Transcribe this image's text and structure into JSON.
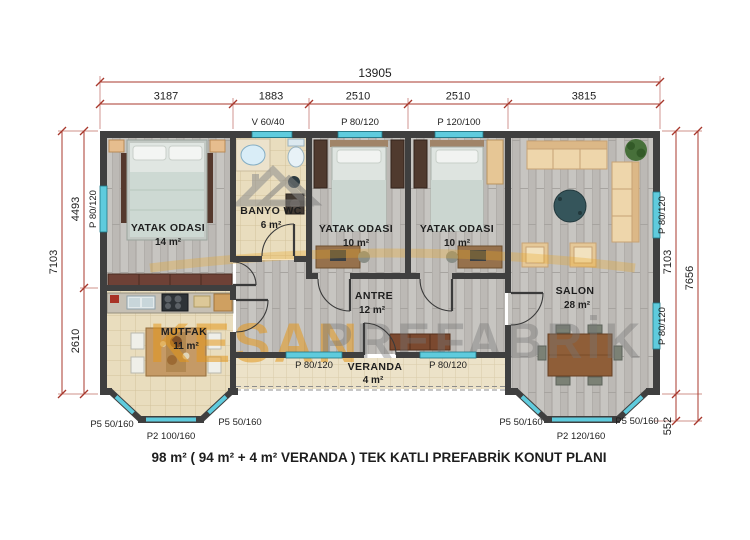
{
  "plan": {
    "caption": "98 m²  ( 94 m² + 4 m²  VERANDA ) TEK KATLI PREFABRİK KONUT  PLANI",
    "watermark_brand": "KESAN",
    "watermark_brand2": "PREFABRİK"
  },
  "rooms": {
    "bedroom1": {
      "name": "YATAK ODASI",
      "area": "14 m²"
    },
    "bathroom": {
      "name": "BANYO WC",
      "area": "6 m²"
    },
    "bedroom2": {
      "name": "YATAK ODASI",
      "area": "10 m²"
    },
    "bedroom3": {
      "name": "YATAK ODASI",
      "area": "10 m²"
    },
    "salon": {
      "name": "SALON",
      "area": "28 m²"
    },
    "antre": {
      "name": "ANTRE",
      "area": "12 m²"
    },
    "kitchen": {
      "name": "MUTFAK",
      "area": "11 m²"
    },
    "veranda": {
      "name": "VERANDA",
      "area": "4 m²"
    }
  },
  "dims": {
    "total_width": "13905",
    "seg1": "3187",
    "seg2": "1883",
    "seg3": "2510",
    "seg4": "2510",
    "seg5": "3815",
    "left_total": "7103",
    "left_top": "4493",
    "left_bottom": "2610",
    "right_inner": "7103",
    "right_total": "7656",
    "right_bay": "552"
  },
  "openings": {
    "top_vent": "V 60/40",
    "top_win1": "P 80/120",
    "top_win2": "P 120/100",
    "left_win": "P 80/120",
    "right_win_top": "P 80/120",
    "right_win_bottom": "P 80/120",
    "veranda_win_left": "P 80/120",
    "veranda_win_right": "P 80/120",
    "kbay_left": "P5 50/160",
    "kbay_center": "P2 100/160",
    "kbay_right": "P5 50/160",
    "sbay_left": "P5 50/160",
    "sbay_center": "P2 120/160",
    "sbay_right": "P5 50/160"
  },
  "colors": {
    "wall": "#3f3f3f",
    "window": "#5fcbdd",
    "dim_line": "#a8382c",
    "brand_orange": "#e4981c"
  }
}
